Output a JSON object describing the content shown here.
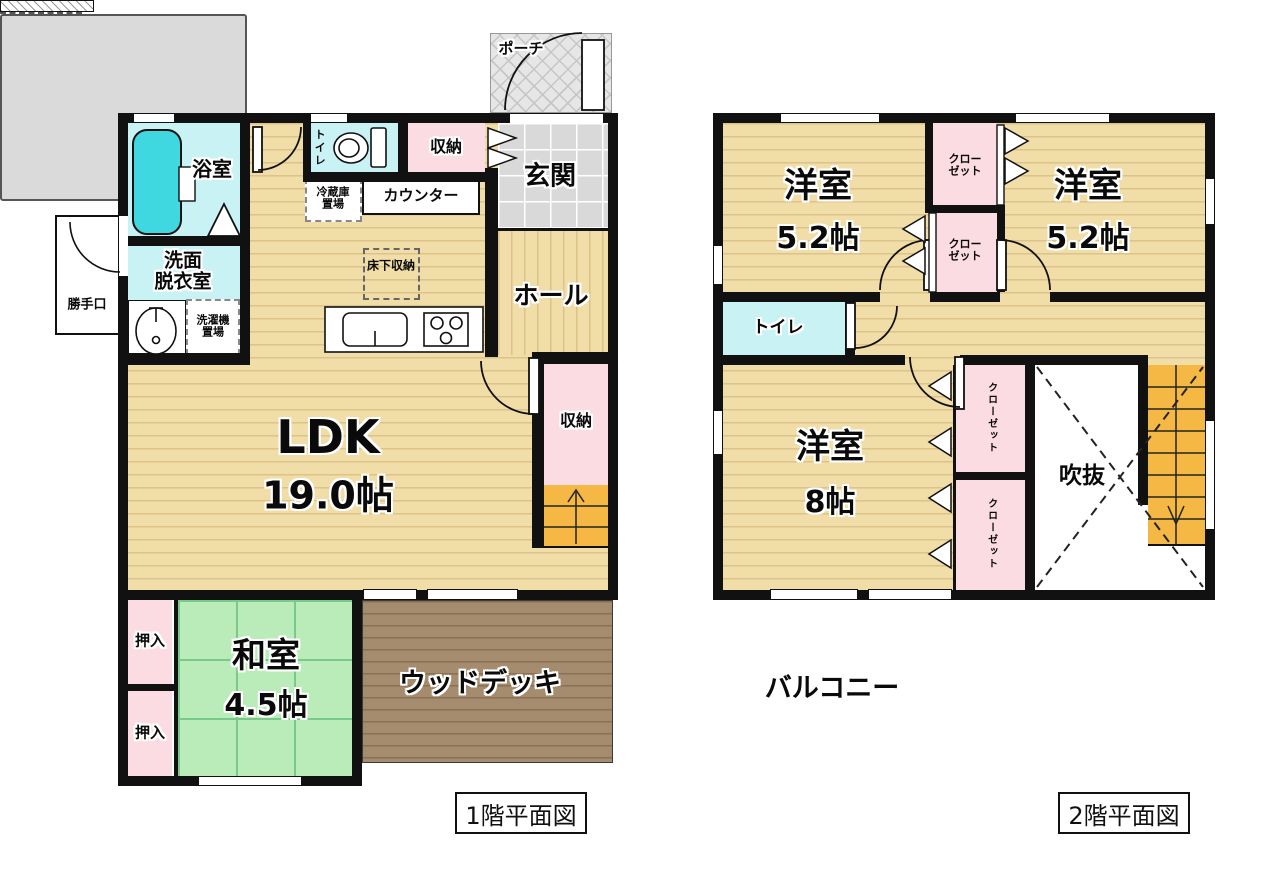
{
  "floor1": {
    "title": "1階平面図",
    "labels": {
      "porch": "ポーチ",
      "entrance": "玄関",
      "hall": "ホール",
      "storage_top": "収納",
      "toilet": "トイレ",
      "bathroom": "浴室",
      "washroom": "洗面\n脱衣室",
      "back_door": "勝手口",
      "fridge_space": "冷蔵庫\n置場",
      "counter": "カウンター",
      "underfloor_storage": "床下収納",
      "washing_machine": "洗濯機\n置場",
      "ldk_name": "LDK",
      "ldk_size": "19.0帖",
      "storage_side": "収納",
      "japanese_room_name": "和室",
      "japanese_room_size": "4.5帖",
      "oshiire_upper": "押入",
      "oshiire_lower": "押入",
      "wood_deck": "ウッドデッキ"
    }
  },
  "floor2": {
    "title": "2階平面図",
    "labels": {
      "bedroom_left_name": "洋室",
      "bedroom_left_size": "5.2帖",
      "bedroom_right_name": "洋室",
      "bedroom_right_size": "5.2帖",
      "bedroom_main_name": "洋室",
      "bedroom_main_size": "8帖",
      "closet_top_1": "クロー\nゼット",
      "closet_top_2": "クロー\nゼット",
      "closet_side_1": "クローゼット",
      "closet_side_2": "クローゼット",
      "toilet": "トイレ",
      "void": "吹抜",
      "balcony": "バルコニー"
    }
  },
  "colors": {
    "flooring": "#f1dda8",
    "tatami": "#b9ecb9",
    "wet_room": "#c9f2f4",
    "closet_pink": "#fbdce2",
    "stairs_orange": "#f6b845",
    "deck_brown": "#a58c6e",
    "balcony_gray": "#dadada",
    "wall_black": "#111111"
  }
}
